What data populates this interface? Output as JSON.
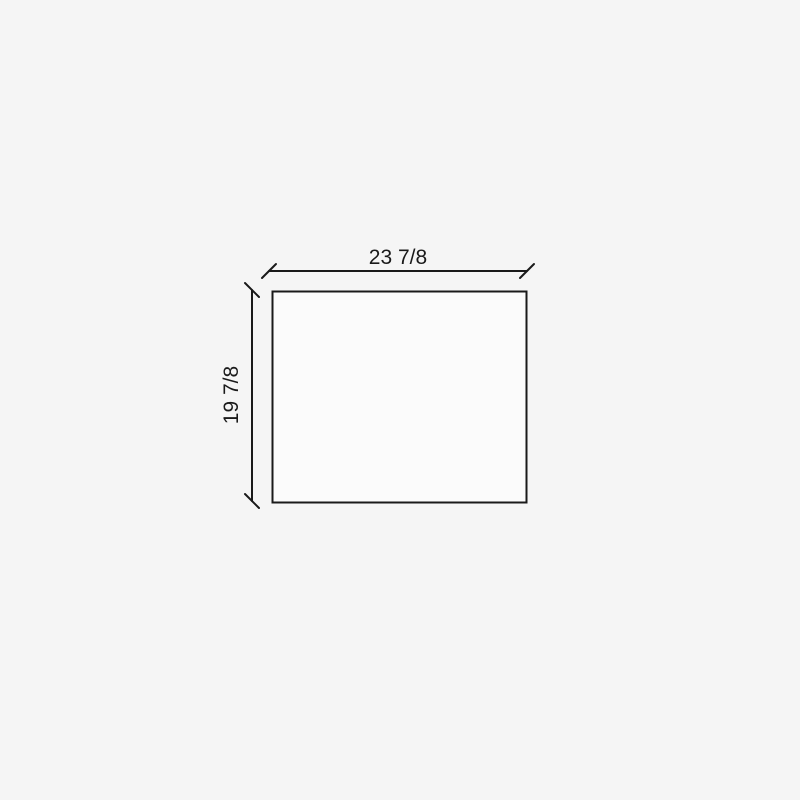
{
  "drawing": {
    "width_label": "23 7/8",
    "height_label": "19 7/8"
  },
  "colors": {
    "background": "#f5f5f5",
    "line": "#1a1a1a",
    "shape_fill": "#fbfbfb"
  }
}
